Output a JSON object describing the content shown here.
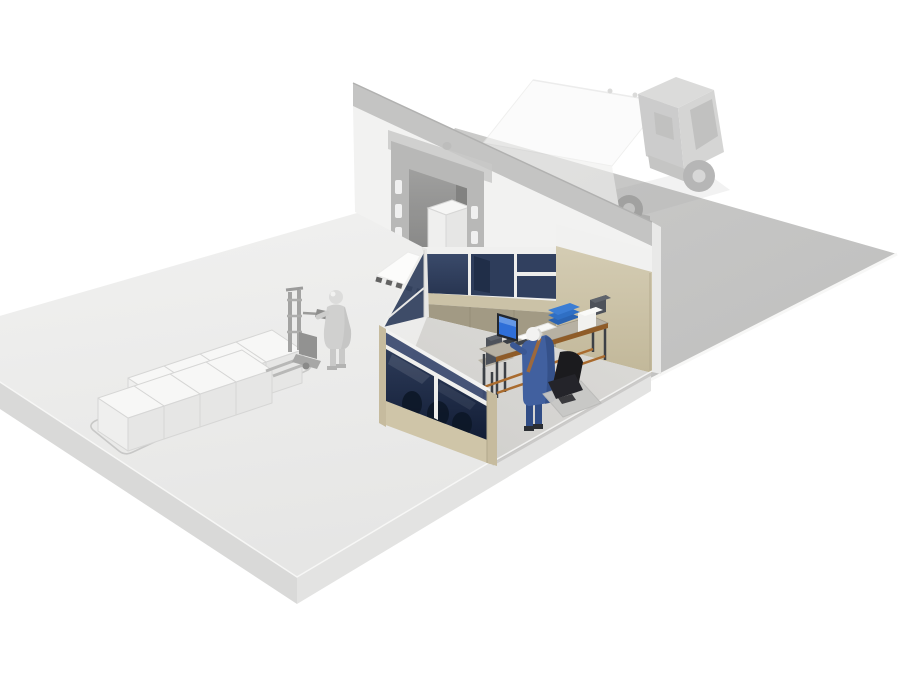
{
  "meta": {
    "description": "Isometric 3D cutaway illustration of a warehouse loading dock area: a ghosted semi truck docked at a dock door in the rear wall, a glass-partition dispatch office with a worker at a computer desk, and ghosted palletized boxes with a walkie stacker and operator on the warehouse floor.",
    "style": "3d-isometric-render",
    "visible_text": []
  },
  "colors": {
    "background": "#ffffff",
    "outdoor_ground": "#c6c6c5",
    "ground_edge": "#f7f7f6",
    "wall_face": "#f2f2f1",
    "wall_band": "#c4c4c3",
    "wall_band_top": "#b1b1b0",
    "wall_end": "#e9e9e8",
    "dock_header": "#c9c9c8",
    "dock_frame": "#b4b4b3",
    "dock_slot": "#fafafa",
    "dock_opening_dark": "#6f6f6e",
    "ramp": "#fcfcfb",
    "hatch": "#2e2e2e",
    "slab_edge_sw": "#d9d9d8",
    "slab_edge_se": "#e3e3e2",
    "office_floor_edge": "#c6c5c3",
    "tan_base": "#cfc5a8",
    "tan_cap": "#c6bb9e",
    "tan_light": "#cbc2a7",
    "tan_dark": "#a29a84",
    "mullion": "#eeeeec",
    "glass_p1": "#3a4a6a",
    "glass_p2": "#2e3d5b",
    "glass_p3": "#31405f",
    "glass_dark_sil": "#1d2a44",
    "glass_transom": "#3e4d72",
    "glass_blob": "#0c1626",
    "desk_top": "#b7b1a3",
    "desk_orange": "#a96b2e",
    "desk_edge": "#8f5c28",
    "desk_leg": "#3c4046",
    "monitor_frame": "#23272e",
    "monitor_screen": "#2f6fd8",
    "monitor_screen_hi": "#6b9ce8",
    "keyboard": "#3f444b",
    "paper": "#fcfcfa",
    "tray_blue": "#2f6fc4",
    "tray_blue_dark": "#2a63b2",
    "printer_white": "#f1f1ef",
    "printer_dark": "#4e525a",
    "worker_coat": "#41609f",
    "worker_leg": "#314d86",
    "worker_head": "#f2f2f1",
    "strap": "#a86a32",
    "chair_black": "#1b1b1e",
    "chair_seat": "#24242a",
    "chair_mat": "#c8c8c6",
    "ghost_light": "#d0d0cf",
    "ghost_mid": "#b5b5b4",
    "ghost_dark": "#929291",
    "zone_stroke": "#c8c8c7",
    "box_top": "#f7f7f6",
    "box_sw": "#efefee",
    "box_se": "#e6e6e5",
    "box_stroke": "#d6d6d5",
    "truck_top": "#fafaf9",
    "truck_side": "#efefee",
    "truck_stroke": "#e6e6e5",
    "cab_roof": "#c6c6c5",
    "cab_side": "#aeaead",
    "cab_front": "#bcbcbb",
    "cab_window": "#9c9c9b",
    "chassis": "#9f9f9e",
    "wheel": "#8b8b8a",
    "wheel_hub": "#c0c0bf"
  },
  "pallet_boxes": {
    "vectors": {
      "b": [
        36,
        -12
      ],
      "a": [
        30,
        20
      ],
      "h": 33
    },
    "rows": [
      {
        "name": "back",
        "positions": [
          [
            236,
            342
          ],
          [
            200,
            354
          ],
          [
            164,
            366
          ],
          [
            128,
            378
          ]
        ]
      },
      {
        "name": "front",
        "positions": [
          [
            206,
            362
          ],
          [
            170,
            374
          ],
          [
            134,
            386
          ],
          [
            98,
            398
          ]
        ]
      }
    ]
  },
  "inventory": [
    {
      "name": "warehouse-floor-slab",
      "ghosted": false
    },
    {
      "name": "outdoor-ground",
      "ghosted": false
    },
    {
      "name": "warehouse-rear-wall",
      "ghosted": false
    },
    {
      "name": "loading-dock-door",
      "ghosted": true
    },
    {
      "name": "dock-shelter-frame",
      "ghosted": true
    },
    {
      "name": "box-on-dock-leveler",
      "ghosted": true
    },
    {
      "name": "dock-ramp-hazard-stripes",
      "ghosted": false
    },
    {
      "name": "semi-truck-at-dock",
      "ghosted": true
    },
    {
      "name": "dispatch-office",
      "ghosted": false
    },
    {
      "name": "glass-partition-walls",
      "ghosted": false
    },
    {
      "name": "office-desk",
      "ghosted": false
    },
    {
      "name": "desktop-monitor",
      "ghosted": false
    },
    {
      "name": "document-trays",
      "ghosted": false
    },
    {
      "name": "printer",
      "ghosted": false
    },
    {
      "name": "office-worker",
      "ghosted": false
    },
    {
      "name": "office-chair",
      "ghosted": false
    },
    {
      "name": "palletized-boxes",
      "ghosted": true
    },
    {
      "name": "walkie-stacker",
      "ghosted": true
    },
    {
      "name": "warehouse-operator",
      "ghosted": true
    },
    {
      "name": "floor-marking-zone",
      "ghosted": true
    }
  ]
}
